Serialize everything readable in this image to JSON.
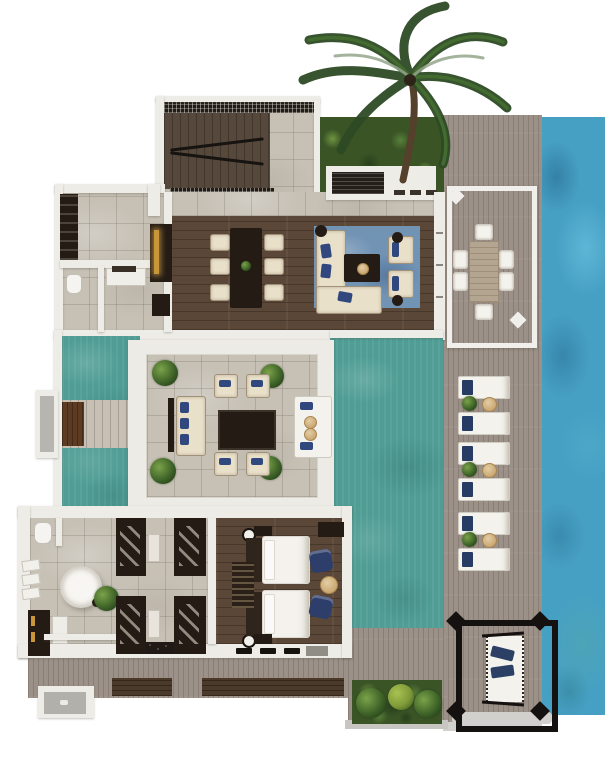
{
  "scene": {
    "type": "3d-villa-floor-plan",
    "regions": [
      "ocean",
      "sun-deck",
      "garden",
      "staircase-hall",
      "living-dining-room",
      "pantry",
      "guest-toilet",
      "powder-room",
      "outdoor-dining-pavilion",
      "central-lounge-pavilion",
      "pool",
      "entry-bridge",
      "bathroom",
      "dressing-area",
      "bedroom",
      "overwater-hammock",
      "rear-deck"
    ],
    "counts": {
      "sun_loungers": 6,
      "dining_chairs": 6,
      "outdoor_dining_chairs": 6,
      "pavilion_armchairs": 4,
      "beds": 2,
      "bedroom_armchairs": 2,
      "wardrobes": 4,
      "pavilion_potted_plants": 4
    }
  },
  "palette": {
    "ocean": "#46a0c4",
    "pool": "#4f9d95",
    "deck": "#9c9188",
    "deck_walkway": "#4b3929",
    "stone": "#c6c0b5",
    "wall": "#eeece7",
    "wood_floor": "#5b4737",
    "stair_wood": "#57483c",
    "dark_wood": "#241c14",
    "cream": "#e9e0ca",
    "navy": "#31487e",
    "rug_blue": "#7193b4",
    "garden_green": "#3a5426",
    "palm_green": "#2d4a24",
    "gold": "#c9973a",
    "white_fabric": "#f4f2ed",
    "tan": "#d2b98c",
    "lattice": "#221c16",
    "shadow": "#d2d0cc"
  }
}
